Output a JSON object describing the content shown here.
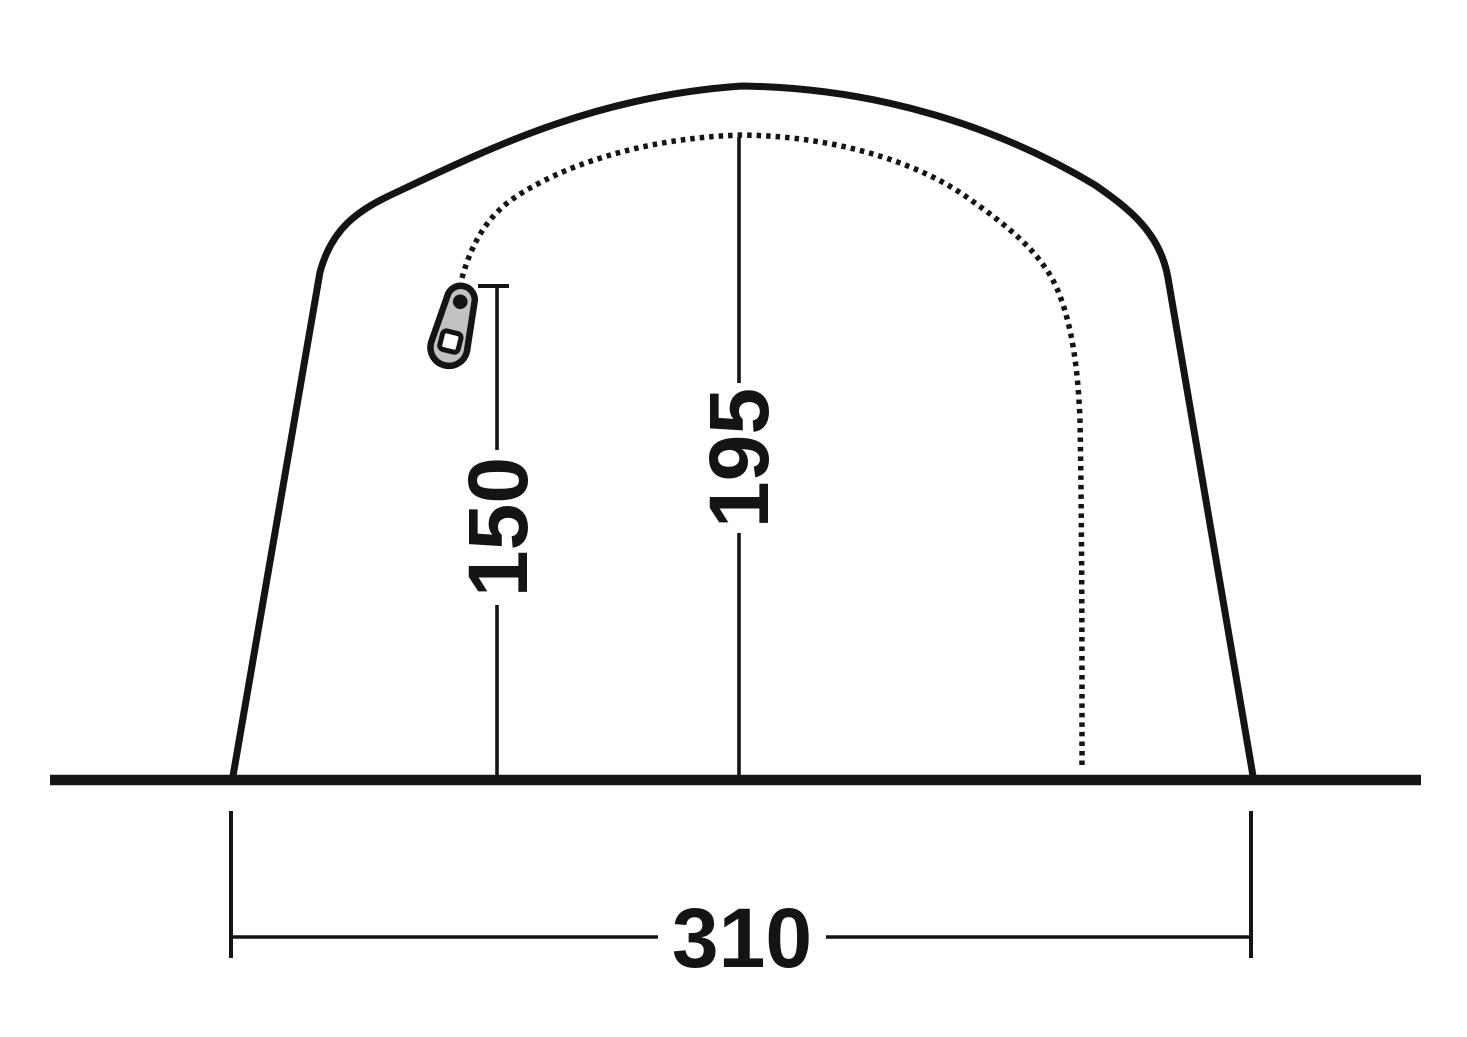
{
  "diagram": {
    "name": "tent-front-view-dimension-diagram",
    "measurements": {
      "door_height": "150",
      "peak_height": "195",
      "base_width": "310"
    },
    "colors": {
      "line": "#141414",
      "background": "#ffffff",
      "zipper_pull_fill": "#c2c2c2",
      "zipper_pull_hole": "#ffffff"
    },
    "icons": {
      "zipper": "zipper-pull-icon"
    }
  }
}
